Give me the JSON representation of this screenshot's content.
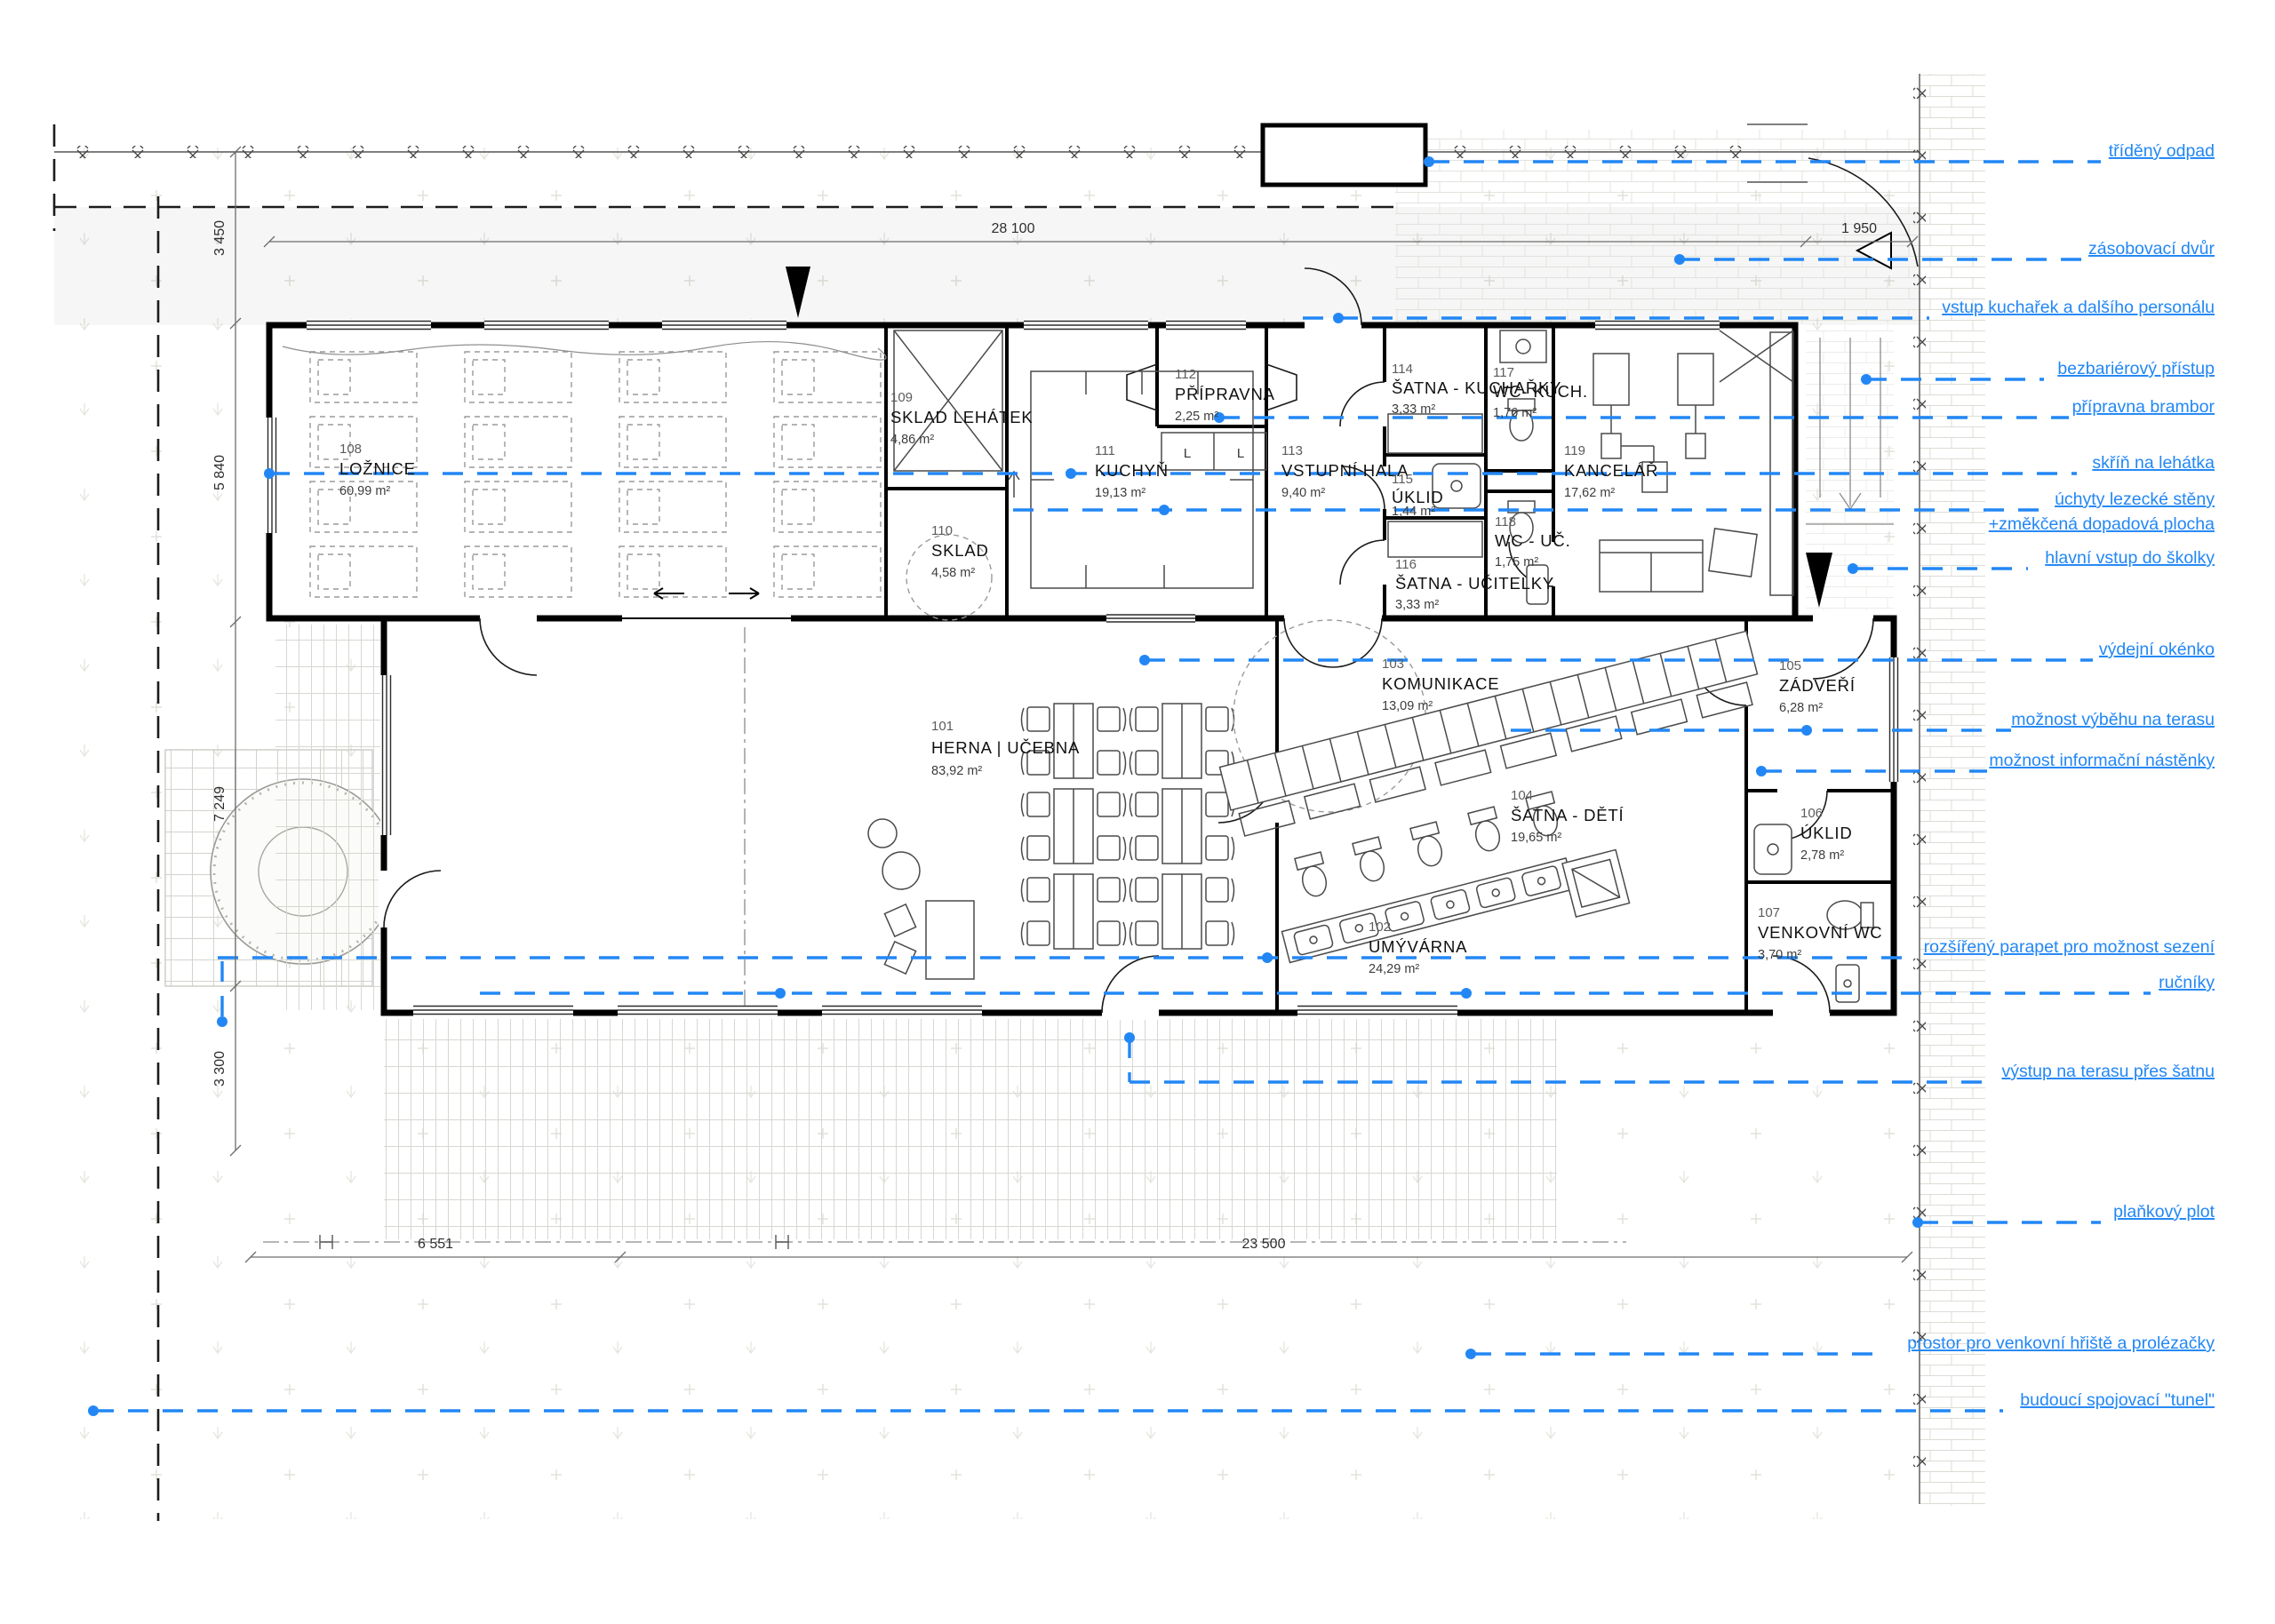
{
  "title": "půdorys 1NP — mateřská školka",
  "colors": {
    "callout": "#2287f5",
    "wall": "#000000",
    "ground": "#f2f2ef"
  },
  "rooms": [
    {
      "num": "101",
      "name": "HERNA | UČEBNA",
      "area": "83,92 m²"
    },
    {
      "num": "102",
      "name": "UMÝVÁRNA",
      "area": "24,29 m²"
    },
    {
      "num": "103",
      "name": "KOMUNIKACE",
      "area": "13,09 m²"
    },
    {
      "num": "104",
      "name": "ŠATNA - DĚTÍ",
      "area": "19,65 m²"
    },
    {
      "num": "105",
      "name": "ZÁDVEŘÍ",
      "area": "6,28 m²"
    },
    {
      "num": "106",
      "name": "ÚKLID",
      "area": "2,78 m²"
    },
    {
      "num": "107",
      "name": "VENKOVNÍ WC",
      "area": "3,70 m²"
    },
    {
      "num": "108",
      "name": "LOŽNICE",
      "area": "60,99 m²"
    },
    {
      "num": "109",
      "name": "SKLAD LEHÁTEK",
      "area": "4,86 m²"
    },
    {
      "num": "110",
      "name": "SKLAD",
      "area": "4,58 m²"
    },
    {
      "num": "111",
      "name": "KUCHYŇ",
      "area": "19,13 m²"
    },
    {
      "num": "112",
      "name": "PŘÍPRAVNA",
      "area": "2,25 m²"
    },
    {
      "num": "113",
      "name": "VSTUPNÍ HALA",
      "area": "9,40 m²"
    },
    {
      "num": "114",
      "name": "ŠATNA - KUCHAŘKY",
      "area": "3,33 m²"
    },
    {
      "num": "115",
      "name": "ÚKLID",
      "area": "1,44 m²"
    },
    {
      "num": "116",
      "name": "ŠATNA - UČITELKY",
      "area": "3,33 m²"
    },
    {
      "num": "117",
      "name": "WC- KUCH.",
      "area": "1,76 m²"
    },
    {
      "num": "118",
      "name": "WC - UČ.",
      "area": "1,75 m²"
    },
    {
      "num": "119",
      "name": "KANCELÁŘ",
      "area": "17,62 m²"
    }
  ],
  "callouts": [
    {
      "label": "tříděný odpad"
    },
    {
      "label": "zásobovací dvůr"
    },
    {
      "label": "vstup kuchařek a dalšího personálu"
    },
    {
      "label": "bezbariérový přístup"
    },
    {
      "label": "přípravna brambor"
    },
    {
      "label": "skříň na lehátka"
    },
    {
      "label": "úchyty lezecké stěny",
      "label2": "+změkčená dopadová plocha"
    },
    {
      "label": "hlavní vstup do školky"
    },
    {
      "label": "výdejní okénko"
    },
    {
      "label": "možnost výběhu na terasu"
    },
    {
      "label": "možnost informační nástěnky"
    },
    {
      "label": "rozšířený parapet pro možnost sezení"
    },
    {
      "label": "ručníky"
    },
    {
      "label": "výstup na terasu přes šatnu"
    },
    {
      "label": "plaňkový plot"
    },
    {
      "label": "prostor pro venkovní hřiště a prolézačky"
    },
    {
      "label": "budoucí spojovací \"tunel\""
    }
  ],
  "dimensions": {
    "top": "28 100",
    "gate": "1 950",
    "left": [
      "3 450",
      "5 840",
      "7 249",
      "3 300"
    ],
    "bottom": [
      "6 551",
      "23 500"
    ]
  },
  "lockers": [
    "L",
    "L"
  ]
}
